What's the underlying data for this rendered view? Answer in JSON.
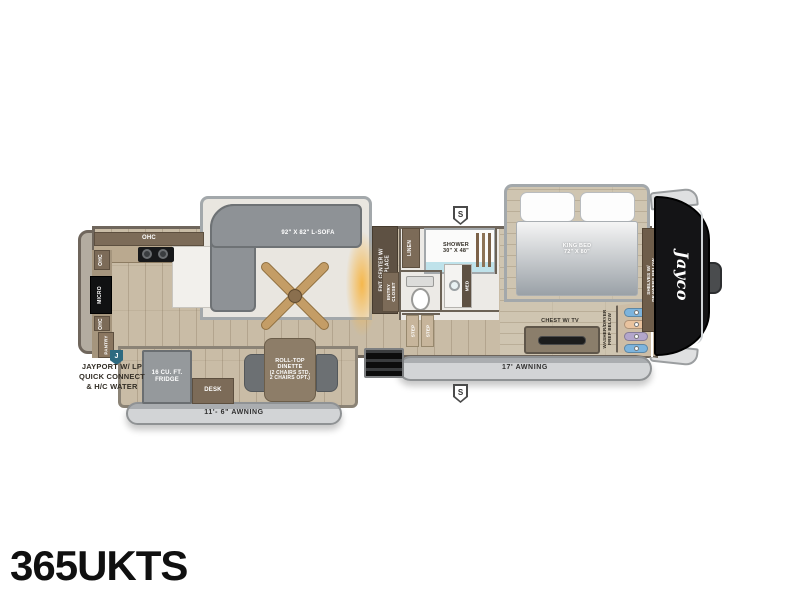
{
  "title": "365UKTS",
  "brand": {
    "logo": "Jayco"
  },
  "markers": {
    "jayport": "J",
    "s_top": "S",
    "s_bottom": "S"
  },
  "exterior": {
    "awning_main": "17' AWNING",
    "awning_rear": "11'- 6\" AWNING",
    "jayport_note_lines": [
      "JAYPORT W/ LP",
      "QUICK CONNECT",
      "& H/C WATER"
    ]
  },
  "kitchen": {
    "ohc_top": "OHC",
    "ohc_upper": "OHC",
    "ohc_lower": "OHC",
    "micro": "MICRO",
    "pantry": "PANTRY",
    "fridge_lines": [
      "16 CU. FT.",
      "FRIDGE"
    ],
    "desk": "DESK"
  },
  "living": {
    "sofa": "92\" X 82\" L-SOFA",
    "dinette_lines": [
      "ROLL-TOP",
      "DINETTE",
      "(2 CHAIRS STD,",
      "2 CHAIRS OPT.)"
    ],
    "ent_center_lines": [
      "ENT. CENTER W/",
      "FIREPLACE"
    ]
  },
  "bath": {
    "shower_lines": [
      "SHOWER",
      "30\" X 48\""
    ],
    "linen": "LINEN",
    "entry_closet_lines": [
      "ENTRY",
      "CLOSET"
    ],
    "med": "MED",
    "step1": "STEP",
    "step2": "STEP"
  },
  "bedroom": {
    "bed_lines": [
      "KING BED",
      "72\" X 80\""
    ],
    "chest": "CHEST W/ TV",
    "washer_lines": [
      "WASHER/DRYER",
      "PREP BELOW"
    ],
    "shelves_lines": [
      "SHELVES W/",
      "DRAWERS BELOW"
    ]
  },
  "icons": {
    "ceiling_fan": "crossed-wood-blades",
    "hangers": "clothes-hangers",
    "cooktop": "two-burner-cooktop",
    "toilet": "toilet-top-view"
  },
  "colors": {
    "wall": "#6b6256",
    "floor_main": "#c9bca6",
    "floor_bedroom": "#cfc5b1",
    "cabinet": "#7c6b58",
    "sofa_grey": "#8e9296",
    "awning_grey": "#d2d4d6",
    "front_cap": "#141416",
    "fireplace_glow": "#f6b544",
    "jayport_marker": "#2e6a80",
    "shower_floor": "#bfe2ea",
    "hanger_blue": "#7db4dd",
    "hanger_tan": "#e9c39f",
    "hanger_purple": "#b3a6cb"
  }
}
